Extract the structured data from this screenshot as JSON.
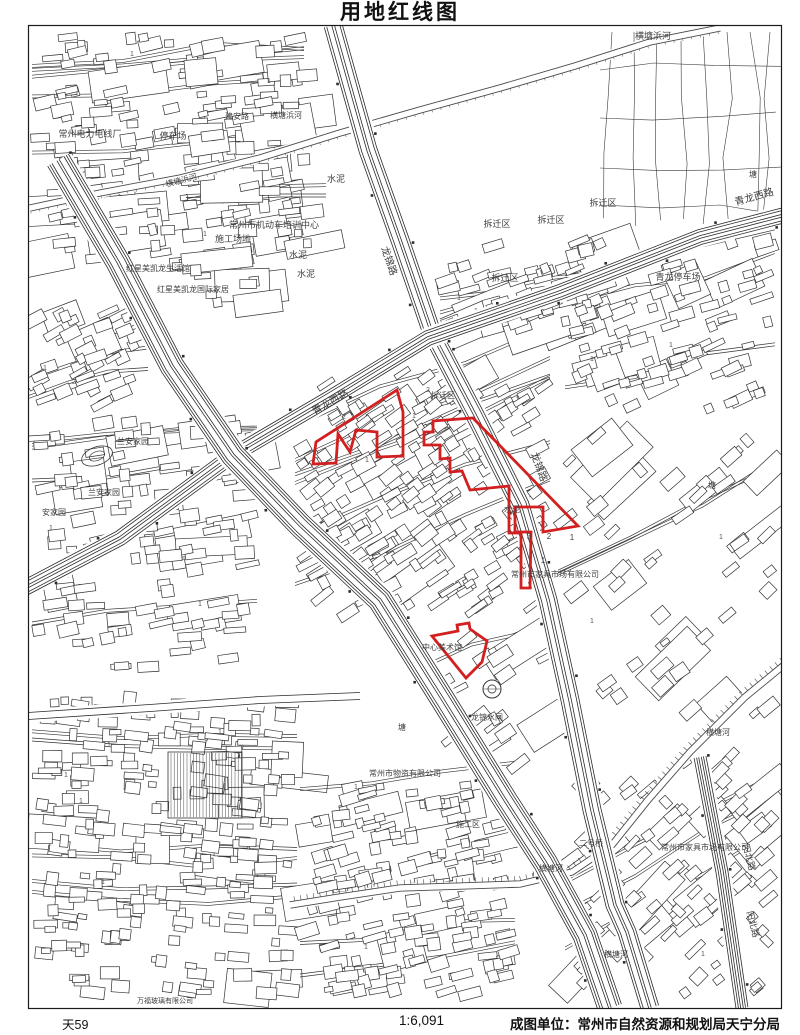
{
  "title": "用地红线图",
  "footer": {
    "sheet_no": "天59",
    "scale": "1:6,091",
    "agency": "成图单位：常州市自然资源和规划局天宁分局"
  },
  "map": {
    "colors": {
      "bg": "#ffffff",
      "building_line": "#333333",
      "road_line": "#2b2b2b",
      "river_line": "#4a4a4a",
      "farm_line": "#3a3a3a",
      "label": "#3f3f3f",
      "redline": "#d21f1f",
      "frame": "#1a1a1a"
    },
    "frame": {
      "x": 28,
      "y": 25,
      "w": 753,
      "h": 983
    },
    "red_parcels": [
      {
        "name": "red-parcel-west",
        "points": [
          [
            397,
            390
          ],
          [
            403,
            412
          ],
          [
            403,
            456
          ],
          [
            377,
            457
          ],
          [
            377,
            432
          ],
          [
            356,
            430
          ],
          [
            350,
            452
          ],
          [
            338,
            434
          ],
          [
            336,
            463
          ],
          [
            313,
            464
          ],
          [
            316,
            442
          ]
        ]
      },
      {
        "name": "red-parcel-main",
        "points": [
          [
            433,
            421
          ],
          [
            473,
            418
          ],
          [
            578,
            526
          ],
          [
            543,
            532
          ],
          [
            543,
            507
          ],
          [
            515,
            507
          ],
          [
            515,
            532
          ],
          [
            531,
            532
          ],
          [
            530,
            588
          ],
          [
            521,
            588
          ],
          [
            521,
            533
          ],
          [
            509,
            533
          ],
          [
            509,
            486
          ],
          [
            470,
            490
          ],
          [
            462,
            471
          ],
          [
            450,
            472
          ],
          [
            450,
            458
          ],
          [
            440,
            459
          ],
          [
            440,
            445
          ],
          [
            424,
            445
          ],
          [
            424,
            432
          ],
          [
            433,
            432
          ]
        ]
      },
      {
        "name": "red-parcel-south",
        "points": [
          [
            432,
            636
          ],
          [
            458,
            631
          ],
          [
            457,
            625
          ],
          [
            469,
            623
          ],
          [
            470,
            629
          ],
          [
            487,
            641
          ],
          [
            482,
            662
          ],
          [
            466,
            678
          ]
        ]
      }
    ],
    "roads": [
      {
        "name": "longjin-road",
        "w": 18,
        "pts": [
          [
            333,
            25
          ],
          [
            368,
            150
          ],
          [
            400,
            240
          ],
          [
            432,
            333
          ],
          [
            475,
            415
          ],
          [
            520,
            505
          ],
          [
            548,
            600
          ],
          [
            570,
            700
          ],
          [
            592,
            810
          ],
          [
            615,
            905
          ],
          [
            627,
            932
          ],
          [
            650,
            1008
          ]
        ]
      },
      {
        "name": "qinglong-west-road",
        "w": 15,
        "pts": [
          [
            0,
            601
          ],
          [
            120,
            538
          ],
          [
            233,
            455
          ],
          [
            330,
            398
          ],
          [
            428,
            338
          ],
          [
            560,
            292
          ],
          [
            700,
            237
          ],
          [
            800,
            211
          ]
        ]
      },
      {
        "name": "longcheng-avenue",
        "w": 24,
        "pts": [
          [
            58,
            160
          ],
          [
            118,
            262
          ],
          [
            172,
            366
          ],
          [
            233,
            455
          ],
          [
            300,
            525
          ],
          [
            380,
            600
          ],
          [
            443,
            700
          ],
          [
            505,
            800
          ],
          [
            545,
            862
          ],
          [
            585,
            935
          ],
          [
            610,
            1008
          ]
        ]
      },
      {
        "name": "minor-road-southwest",
        "w": 7,
        "pts": [
          [
            28,
            716
          ],
          [
            150,
            708
          ],
          [
            260,
            700
          ],
          [
            360,
            696
          ]
        ]
      },
      {
        "name": "yangbei-road",
        "w": 12,
        "pts": [
          [
            700,
            757
          ],
          [
            722,
            872
          ],
          [
            742,
            1008
          ]
        ]
      }
    ],
    "rivers": [
      {
        "name": "hengtangbang-river",
        "hatch": false,
        "pts": [
          [
            30,
            208
          ],
          [
            100,
            193
          ],
          [
            180,
            178
          ],
          [
            260,
            158
          ],
          [
            340,
            133
          ],
          [
            420,
            110
          ],
          [
            500,
            88
          ],
          [
            575,
            66
          ],
          [
            650,
            42
          ],
          [
            720,
            28
          ]
        ]
      },
      {
        "name": "hengtang-river",
        "hatch": true,
        "pts": [
          [
            800,
            652
          ],
          [
            745,
            697
          ],
          [
            690,
            752
          ],
          [
            648,
            800
          ],
          [
            612,
            845
          ],
          [
            572,
            872
          ],
          [
            520,
            884
          ],
          [
            462,
            886
          ],
          [
            400,
            888
          ],
          [
            340,
            897
          ],
          [
            290,
            905
          ]
        ]
      }
    ],
    "farmland": {
      "x": 600,
      "y": 28,
      "w": 178,
      "h": 194
    },
    "districts": [
      {
        "x": 32,
        "y": 30,
        "w": 272,
        "h": 242,
        "a": -8,
        "n": 150,
        "b": 14,
        "l": 5
      },
      {
        "x": 186,
        "y": 62,
        "w": 140,
        "h": 250,
        "a": -6,
        "n": 30,
        "b": 12,
        "l": 2
      },
      {
        "x": 565,
        "y": 235,
        "w": 210,
        "h": 180,
        "a": -20,
        "n": 80,
        "b": 8,
        "l": 3
      },
      {
        "x": 295,
        "y": 365,
        "w": 255,
        "h": 255,
        "a": -33,
        "n": 210,
        "b": 6,
        "l": 6
      },
      {
        "x": 32,
        "y": 415,
        "w": 225,
        "h": 262,
        "a": -8,
        "n": 110,
        "b": 12,
        "l": 4
      },
      {
        "x": 32,
        "y": 688,
        "w": 265,
        "h": 312,
        "a": 3,
        "n": 240,
        "b": 8,
        "l": 6
      },
      {
        "x": 300,
        "y": 778,
        "w": 215,
        "h": 222,
        "a": -12,
        "n": 150,
        "b": 8,
        "l": 4
      },
      {
        "x": 565,
        "y": 748,
        "w": 210,
        "h": 252,
        "a": -42,
        "n": 80,
        "b": 12,
        "l": 3
      },
      {
        "x": 558,
        "y": 428,
        "w": 218,
        "h": 295,
        "a": -40,
        "n": 40,
        "b": 10,
        "l": 2
      },
      {
        "x": 430,
        "y": 625,
        "w": 125,
        "h": 145,
        "a": -33,
        "n": 22,
        "b": 2,
        "l": 1
      },
      {
        "x": 440,
        "y": 235,
        "w": 155,
        "h": 105,
        "a": -18,
        "n": 55,
        "b": 4,
        "l": 2
      },
      {
        "x": 28,
        "y": 300,
        "w": 120,
        "h": 112,
        "a": -25,
        "n": 40,
        "b": 4,
        "l": 2
      }
    ],
    "features": {
      "pond": {
        "x": 492,
        "y": 689,
        "r": 9
      },
      "garden": {
        "x": 97,
        "y": 456
      },
      "greenhouse": {
        "x": 168,
        "y": 752,
        "w": 74,
        "h": 66
      }
    },
    "labels": [
      {
        "x": 653,
        "y": 39,
        "t": "横塘浜河",
        "s": 9
      },
      {
        "x": 182,
        "y": 183,
        "t": "横塘浜河",
        "s": 8,
        "r": -15
      },
      {
        "x": 237,
        "y": 119,
        "t": "建安路",
        "s": 8
      },
      {
        "x": 286,
        "y": 118,
        "t": "横塘浜河",
        "s": 8
      },
      {
        "x": 90,
        "y": 137,
        "t": "常州电力电线厂",
        "s": 9
      },
      {
        "x": 173,
        "y": 139,
        "t": "停车场",
        "s": 9
      },
      {
        "x": 274,
        "y": 228,
        "t": "常州市机动车培训中心",
        "s": 9
      },
      {
        "x": 233,
        "y": 242,
        "t": "施工场地",
        "s": 9
      },
      {
        "x": 158,
        "y": 271,
        "t": "红星美凯龙生活馆",
        "s": 8
      },
      {
        "x": 193,
        "y": 292,
        "t": "红星美凯龙国际家居",
        "s": 8
      },
      {
        "x": 298,
        "y": 258,
        "t": "水泥",
        "s": 9
      },
      {
        "x": 306,
        "y": 277,
        "t": "水泥",
        "s": 9
      },
      {
        "x": 336,
        "y": 182,
        "t": "水泥",
        "s": 9
      },
      {
        "x": 512,
        "y": 512,
        "t": "水泥",
        "s": 8
      },
      {
        "x": 386,
        "y": 262,
        "t": "龙锦路",
        "s": 10,
        "r": 71
      },
      {
        "x": 536,
        "y": 468,
        "t": "龙锦路",
        "s": 10,
        "r": 70
      },
      {
        "x": 332,
        "y": 405,
        "t": "青龙西路",
        "s": 10,
        "r": -30
      },
      {
        "x": 755,
        "y": 200,
        "t": "青龙西路",
        "s": 10,
        "r": -16
      },
      {
        "x": 497,
        "y": 227,
        "t": "拆迁区",
        "s": 9
      },
      {
        "x": 551,
        "y": 223,
        "t": "拆迁区",
        "s": 9
      },
      {
        "x": 603,
        "y": 206,
        "t": "拆迁区",
        "s": 9
      },
      {
        "x": 505,
        "y": 281,
        "t": "拆迁区",
        "s": 9
      },
      {
        "x": 443,
        "y": 398,
        "t": "拆迁区",
        "s": 8
      },
      {
        "x": 678,
        "y": 280,
        "t": "青龙停车场",
        "s": 9
      },
      {
        "x": 133,
        "y": 444,
        "t": "兰安家园",
        "s": 8
      },
      {
        "x": 104,
        "y": 495,
        "t": "兰安家园",
        "s": 8
      },
      {
        "x": 54,
        "y": 515,
        "t": "安家园",
        "s": 8
      },
      {
        "x": 555,
        "y": 577,
        "t": "常州市家具市场有限公司",
        "s": 8
      },
      {
        "x": 705,
        "y": 850,
        "t": "常州市家具市场有限公司",
        "s": 8
      },
      {
        "x": 591,
        "y": 846,
        "t": "二号桥",
        "s": 8
      },
      {
        "x": 551,
        "y": 871,
        "t": "横塘河",
        "s": 8
      },
      {
        "x": 718,
        "y": 735,
        "t": "横塘河",
        "s": 8
      },
      {
        "x": 616,
        "y": 957,
        "t": "横塘河",
        "s": 8
      },
      {
        "x": 746,
        "y": 858,
        "t": "阳北路",
        "s": 9,
        "r": 75
      },
      {
        "x": 750,
        "y": 925,
        "t": "阳北路",
        "s": 9,
        "r": 75
      },
      {
        "x": 442,
        "y": 650,
        "t": "中心美术馆",
        "s": 8
      },
      {
        "x": 487,
        "y": 720,
        "t": "龙锦水闸",
        "s": 8
      },
      {
        "x": 405,
        "y": 776,
        "t": "常州市物资有限公司",
        "s": 8
      },
      {
        "x": 468,
        "y": 827,
        "t": "施工区",
        "s": 8
      },
      {
        "x": 165,
        "y": 1003,
        "t": "万福玻璃有限公司",
        "s": 7
      },
      {
        "x": 402,
        "y": 730,
        "t": "塘",
        "s": 8
      },
      {
        "x": 753,
        "y": 177,
        "t": "塘",
        "s": 8
      },
      {
        "x": 712,
        "y": 488,
        "t": "塘",
        "s": 8
      },
      {
        "x": 529,
        "y": 539,
        "t": "3",
        "s": 8
      },
      {
        "x": 549,
        "y": 539,
        "t": "2",
        "s": 8
      },
      {
        "x": 572,
        "y": 540,
        "t": "1",
        "s": 8
      },
      {
        "x": 543,
        "y": 563,
        "t": "1",
        "s": 8
      }
    ]
  }
}
